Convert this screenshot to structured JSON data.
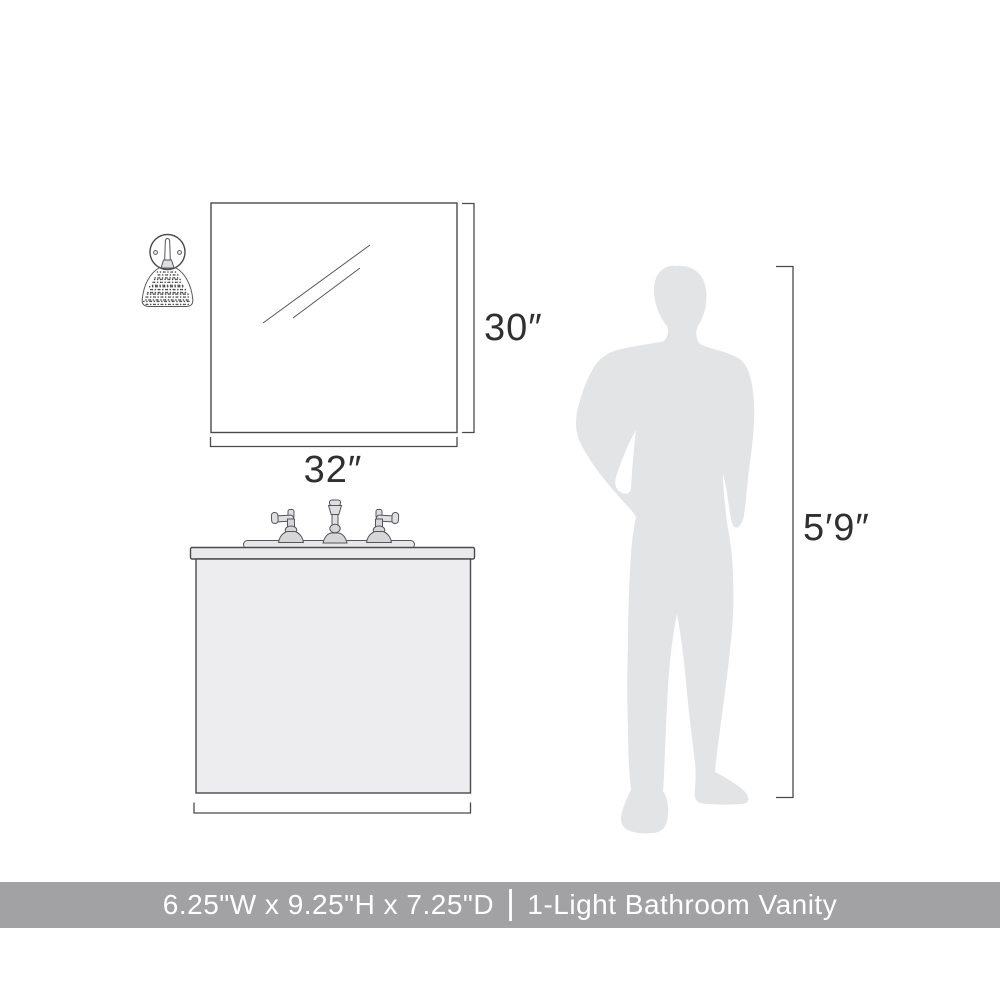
{
  "banner": {
    "dimensions": "6.25\"W x 9.25\"H x 7.25\"D",
    "separator": "|",
    "product_name": "1-Light Bathroom Vanity",
    "background_color": "#a2a2a4",
    "text_color": "#ffffff"
  },
  "dimension_labels": {
    "mirror_width": "32″",
    "mirror_height": "30″",
    "person_height": "5′9″"
  },
  "colors": {
    "line_art": "#4a4a4b",
    "silhouette_fill": "#e3e4e6",
    "cabinet_fill": "#ededef",
    "countertop_fill": "#eaeaec",
    "shade_base": "#dcdcde",
    "shade_speckle": "#4a4a4b",
    "label_text": "#303030"
  },
  "icons": {
    "wall_sconce": "wall-sconce-icon",
    "mirror": "mirror-icon",
    "vanity_cabinet": "vanity-cabinet-icon",
    "faucet": "faucet-icon",
    "person": "person-silhouette-icon"
  }
}
